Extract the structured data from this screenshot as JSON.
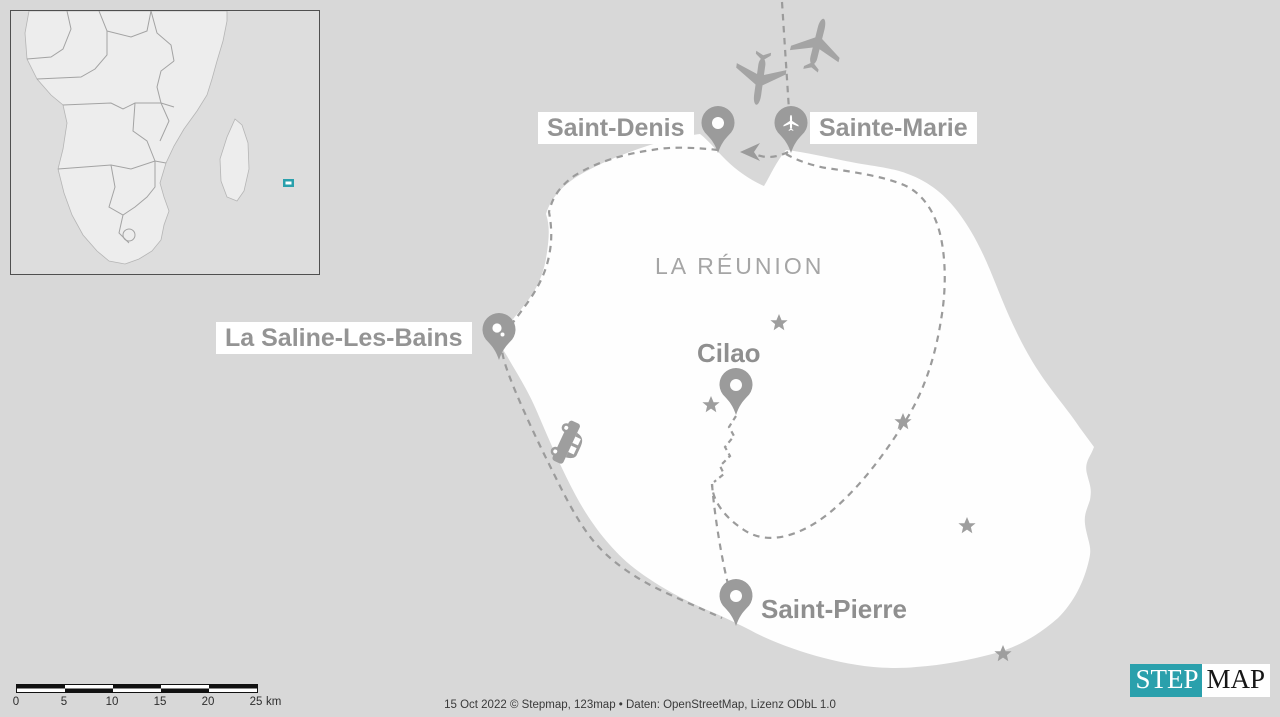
{
  "region": {
    "label": "LA RÉUNION"
  },
  "places": {
    "saint_denis": {
      "label": "Saint-Denis",
      "marker": "pin"
    },
    "sainte_marie": {
      "label": "Sainte-Marie",
      "marker": "pin-airplane"
    },
    "la_saline": {
      "label": "La Saline-Les-Bains",
      "marker": "pin-beach"
    },
    "cilao": {
      "label": "Cilao",
      "marker": "pin"
    },
    "saint_pierre": {
      "label": "Saint-Pierre",
      "marker": "pin"
    }
  },
  "icons": {
    "airplane_arriving": "airplane-icon",
    "airplane_departing": "airplane-icon",
    "car": "car-icon",
    "poi_star_count": 5
  },
  "scale_bar": {
    "ticks": [
      "0",
      "5",
      "10",
      "15",
      "20",
      "25"
    ],
    "unit": "km"
  },
  "attribution": "15 Oct 2022 © Stepmap, 123map • Daten: OpenStreetMap, Lizenz ODbL 1.0",
  "logo": {
    "step": "STEP",
    "map": "MAP"
  },
  "colors": {
    "ocean": "#d8d8d8",
    "island": "#fefefe",
    "marker_gray": "#9b9b9b",
    "inset_highlight": "#2aa0ac",
    "logo_teal": "#2aa0ac"
  }
}
